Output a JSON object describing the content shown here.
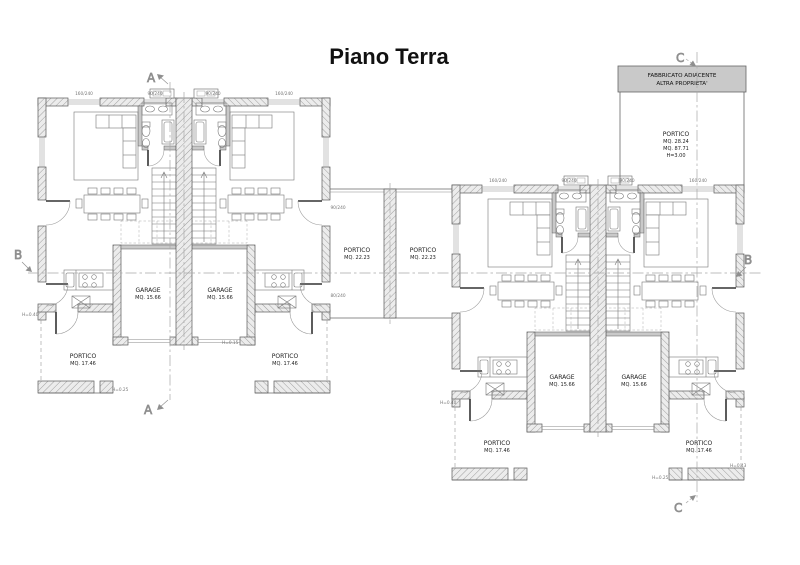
{
  "title": "Piano Terra",
  "annex_building": {
    "line1": "FABBRICATO ADIACENTE",
    "line2": "ALTRA PROPRIETA'"
  },
  "annex_portico": {
    "name": "PORTICO",
    "area_line1": "MQ. 28.24",
    "area_line2": "MQ. 87.71",
    "height": "H=3.00"
  },
  "labels": {
    "portico": "PORTICO",
    "garage": "GARAGE"
  },
  "areas": {
    "center_portico": "MQ. 22.23",
    "garage": "MQ. 15.66",
    "side_portico": "MQ. 17.46"
  },
  "sections": {
    "a": "A",
    "b": "B",
    "c": "C"
  },
  "heights": {
    "h040": "H=0.40",
    "h015": "H=0.15",
    "h025": "H=0.25",
    "h043": "H=0.43"
  },
  "window_dims": {
    "w160": "160/240",
    "w90": "90/240",
    "w80": "80/240"
  },
  "colors": {
    "wall_hatch_bg": "#ececec",
    "wall_line": "#5a5a5a",
    "annex_fill": "#c9c9c9",
    "section_line": "#a8a8a8"
  }
}
